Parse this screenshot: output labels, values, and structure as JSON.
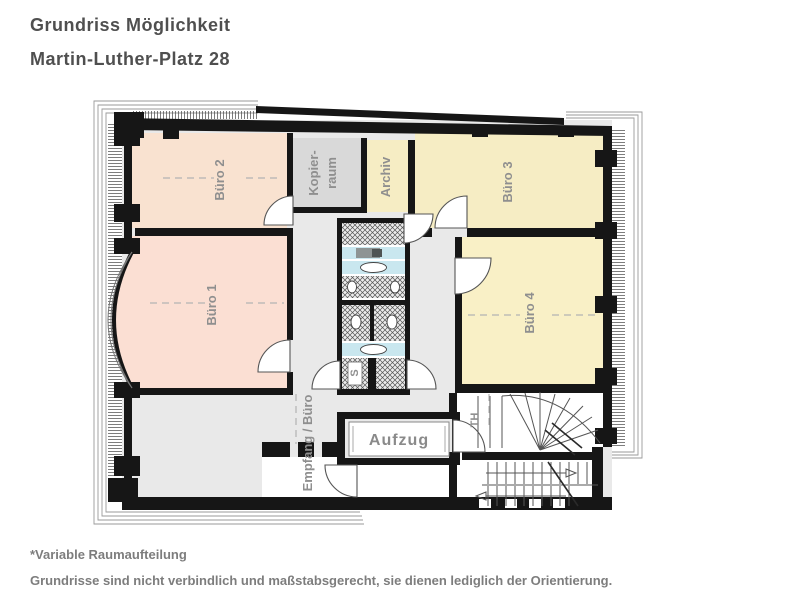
{
  "header": {
    "title": "Grundriss Möglichkeit",
    "subtitle": "Martin-Luther-Platz 28"
  },
  "floorplan": {
    "rooms": {
      "buero1": {
        "label": "Büro 1",
        "color": "#fbdfd3"
      },
      "buero2": {
        "label": "Büro 2",
        "color": "#f9e2d0"
      },
      "buero3": {
        "label": "Büro 3",
        "color": "#f6edc4"
      },
      "buero4": {
        "label": "Büro 4",
        "color": "#f9f0c6"
      },
      "kopierraum": {
        "label_line1": "Kopier-",
        "label_line2": "raum",
        "color": "#d9d9d9"
      },
      "archiv": {
        "label": "Archiv",
        "color": "#f6edc4"
      },
      "empfang": {
        "label": "Empfang / Büro",
        "color": "#e9e9e9"
      },
      "aufzug": {
        "label": "Aufzug"
      },
      "treppenhaus": {
        "label": "TH"
      },
      "schacht": {
        "label": "S"
      }
    },
    "colors": {
      "wall": "#161616",
      "sanitary_blue": "#c9e7ef",
      "corridor_gray": "#e9e9e9"
    }
  },
  "footer": {
    "note1": "*Variable Raumaufteilung",
    "note2": "Grundrisse sind nicht verbindlich und maßstabsgerecht, sie dienen lediglich der Orientierung."
  }
}
